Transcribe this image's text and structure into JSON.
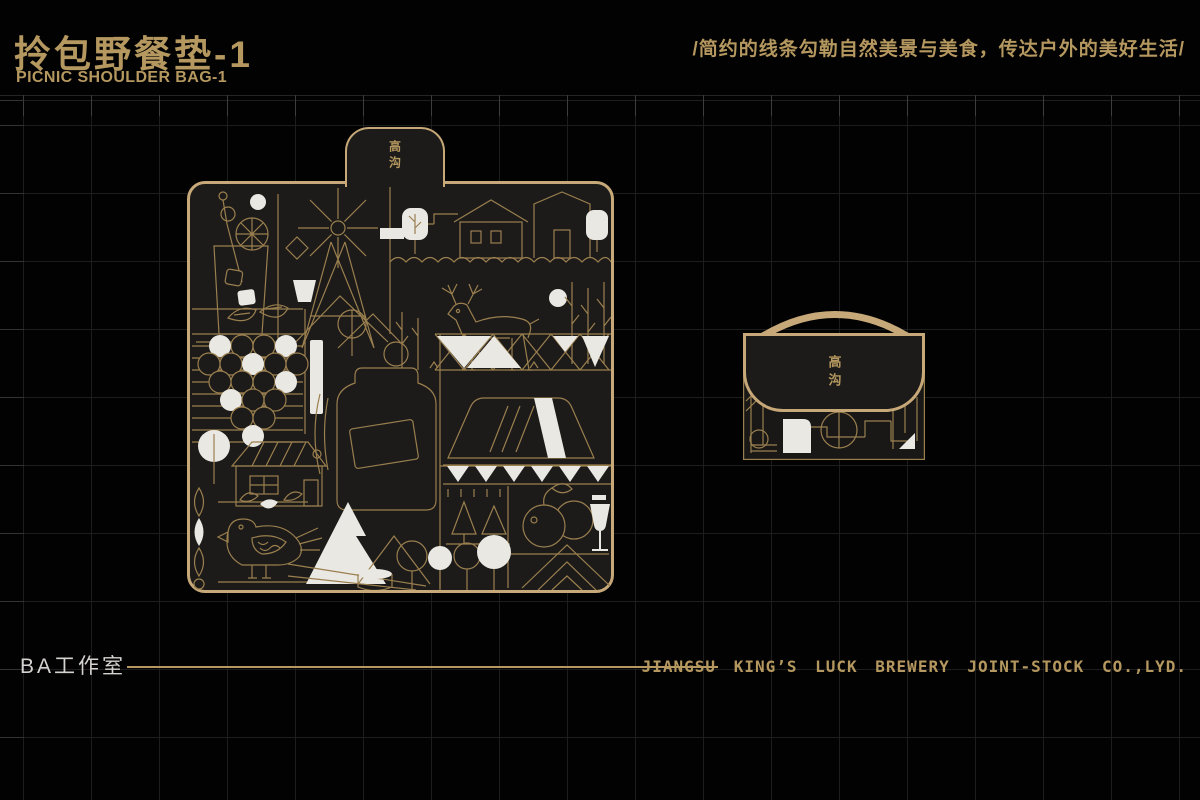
{
  "colors": {
    "bg": "#020202",
    "panel": "#1c1b19",
    "grid": "#1d1d1d",
    "tick": "#3c3c3c",
    "gold": "#b5985f",
    "gold_bright": "#c7a878",
    "gold_line": "#9a7f4f",
    "white": "#eae8e2",
    "gray_text": "#d5d3cf"
  },
  "header": {
    "title_cn": "拎包野餐垫-1",
    "title_en": "PICNIC SHOULDER BAG-1",
    "slogan": "/简约的线条勾勒自然美景与美食，传达户外的美好生活/"
  },
  "mat": {
    "tab_label": "高沟"
  },
  "bag": {
    "flap_label": "高沟"
  },
  "footer": {
    "studio": "BA工作室",
    "company": "JIANGSU KING’S LUCK BREWERY JOINT-STOCK CO.,LYD."
  }
}
